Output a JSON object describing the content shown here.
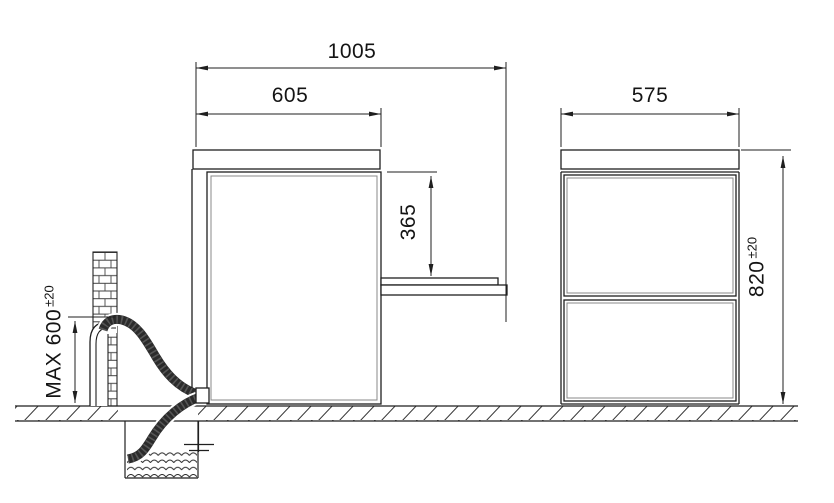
{
  "diagram": {
    "type": "appliance-installation-dimension-drawing",
    "dimensions": {
      "total_depth_door_open": "1005",
      "body_depth": "605",
      "door_open_drop": "365",
      "body_width": "575",
      "body_height": "820",
      "body_height_tolerance": "±20",
      "drain_standpipe_max_height": "MAX 600",
      "drain_standpipe_tolerance": "±20"
    },
    "colors": {
      "line": "#1f1f1f",
      "secondary_line": "#888888",
      "hose": "#2b2b2b",
      "background": "#ffffff"
    }
  }
}
